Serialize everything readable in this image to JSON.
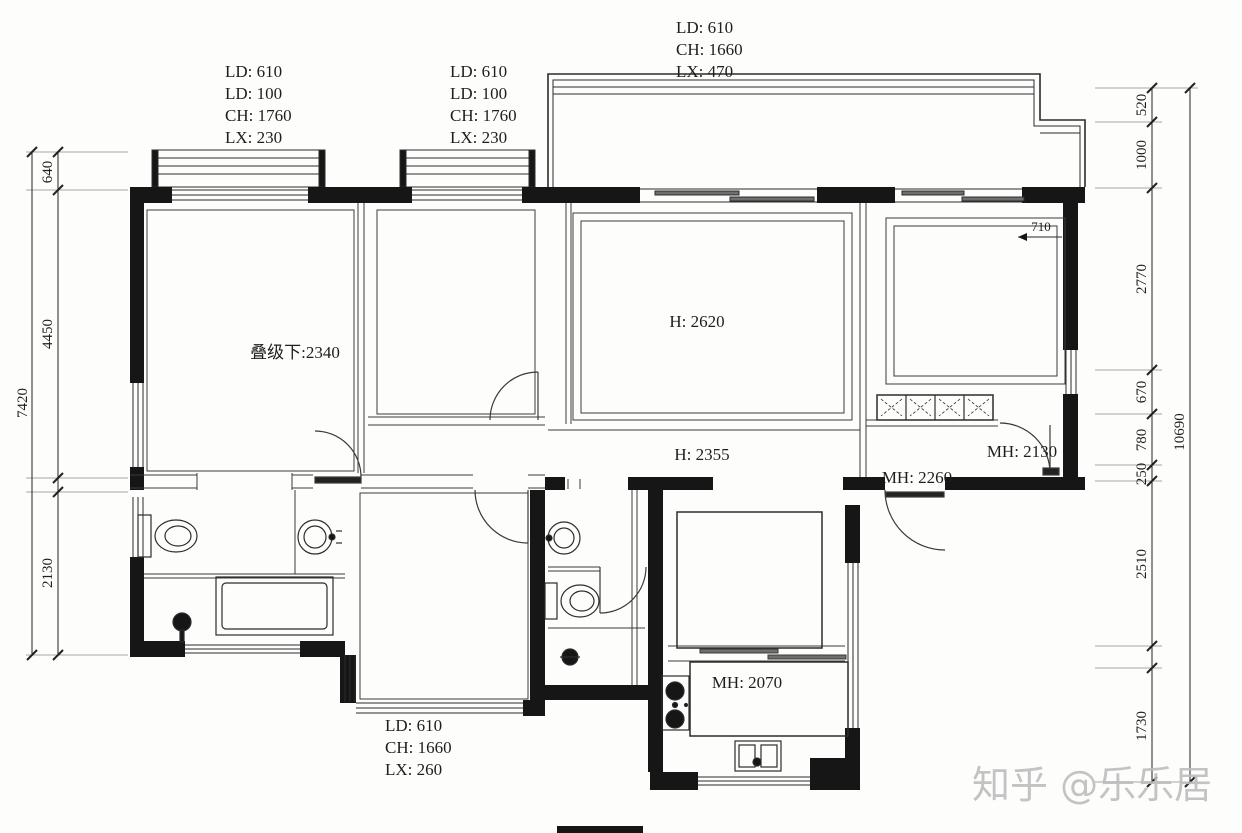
{
  "watermark": "知乎 @乐乐居",
  "window_labels": {
    "top_left": [
      "LD: 610",
      "LD: 100",
      "CH: 1760",
      "LX: 230"
    ],
    "top_mid": [
      "LD: 610",
      "LD: 100",
      "CH: 1760",
      "LX: 230"
    ],
    "top_right": [
      "LD: 610",
      "CH: 1660",
      "LX: 470"
    ],
    "bottom": [
      "LD: 610",
      "CH: 1660",
      "LX: 260"
    ]
  },
  "room_labels": {
    "master_ceiling": "叠级下:2340",
    "living_height": "H: 2620",
    "hall_height": "H: 2355",
    "bedroom_door": "MH: 2130",
    "entry_door": "MH: 2260",
    "kitchen_counter": "MH: 2070",
    "wall_offset": "710"
  },
  "dim_left": {
    "total": "7420",
    "seg": [
      "640",
      "4450",
      "2130"
    ]
  },
  "dim_right": {
    "total": "10690",
    "seg": [
      "520",
      "1000",
      "2770",
      "670",
      "780",
      "250",
      "2510",
      "1730"
    ]
  }
}
